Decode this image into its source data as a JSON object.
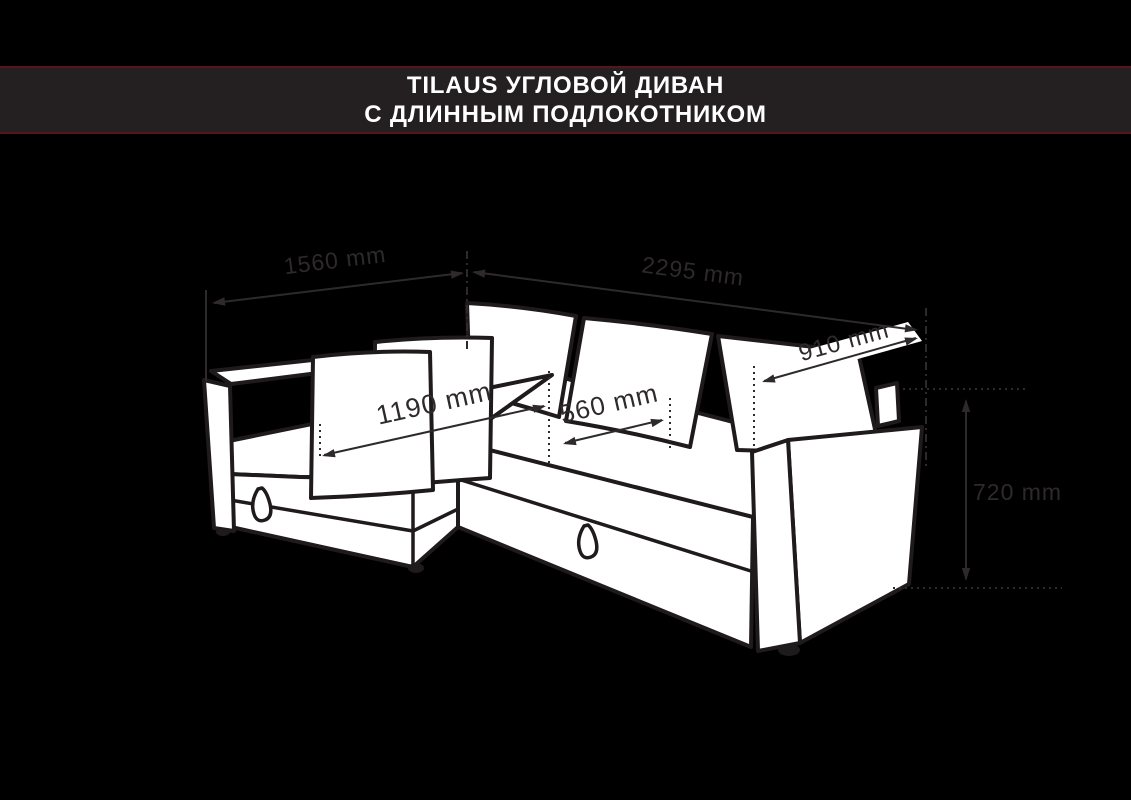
{
  "header": {
    "title_line1": "TILAUS УГЛОВОЙ ДИВАН",
    "title_line2": "С ДЛИННЫМ ПОДЛОКОТНИКОМ",
    "band_color": "#241f20",
    "accent_line_color": "#591616",
    "text_color": "#ffffff"
  },
  "diagram": {
    "subject": "corner sofa with long armrest, dimension drawing",
    "style": {
      "background": "#000000",
      "sofa_fill": "#ffffff",
      "outline_color": "#1f1a1b",
      "dimension_color": "#2e2a2b"
    },
    "dimensions": [
      {
        "id": "chaise-width",
        "label": "1560 mm"
      },
      {
        "id": "sofa-length",
        "label": "2295 mm"
      },
      {
        "id": "backrest-depth",
        "label": "910 mm"
      },
      {
        "id": "chaise-seat-length",
        "label": "1190 mm"
      },
      {
        "id": "seat-depth",
        "label": "560 mm"
      },
      {
        "id": "sofa-height",
        "label": "720 mm"
      }
    ]
  }
}
